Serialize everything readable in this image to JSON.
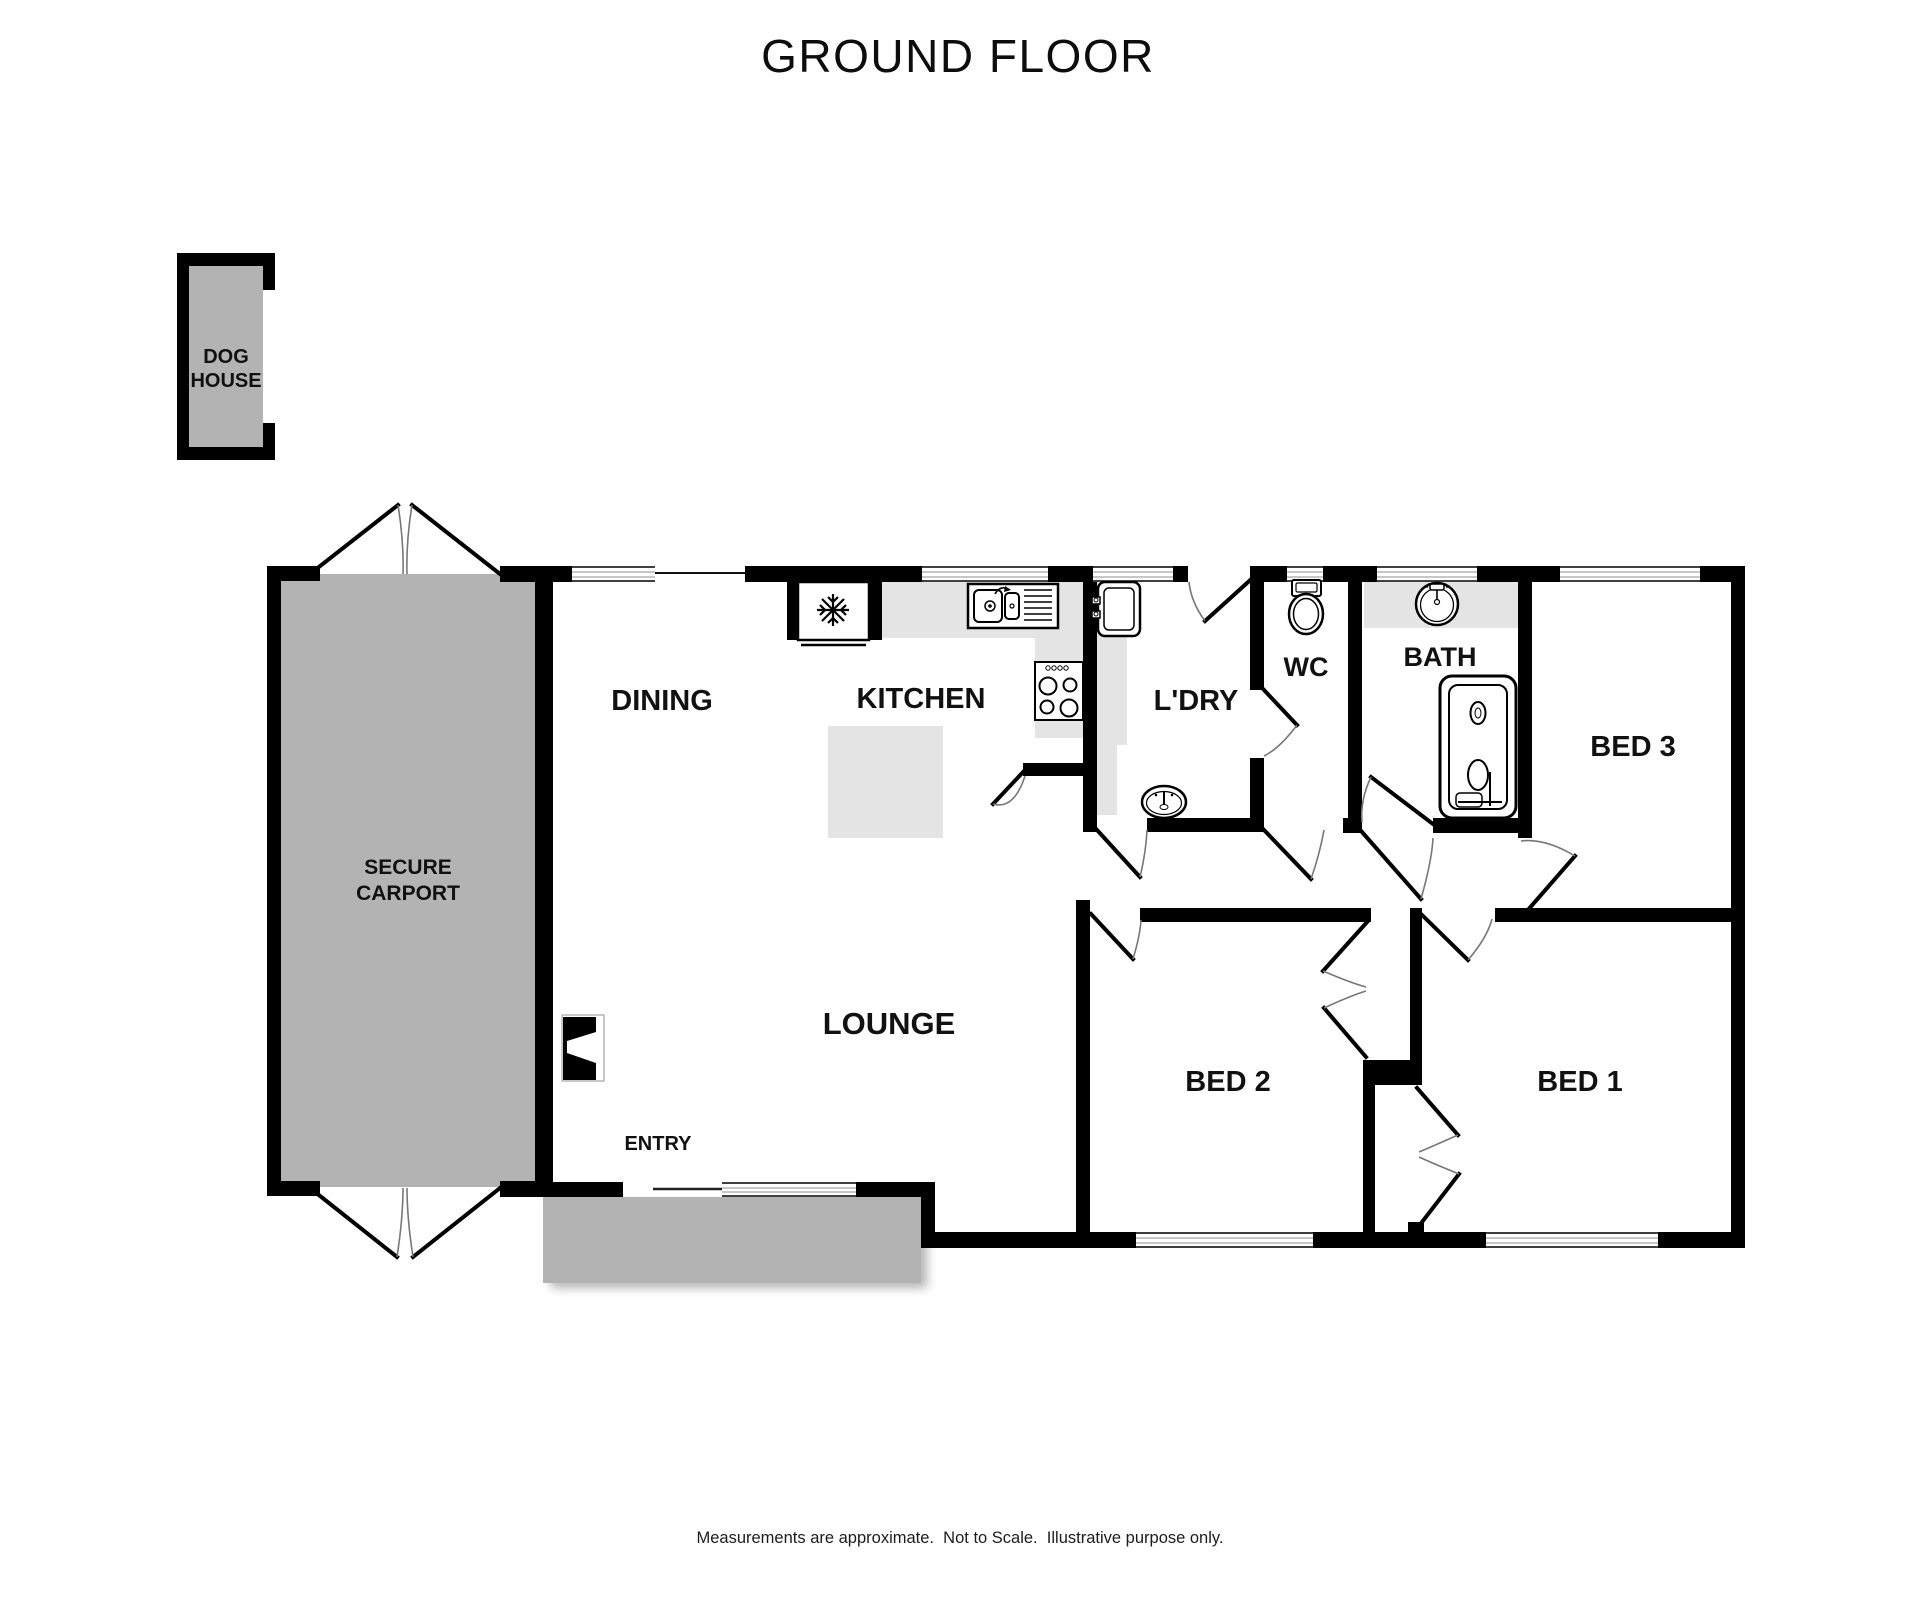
{
  "title": "GROUND FLOOR",
  "disclaimer": "Measurements are approximate.  Not to Scale.  Illustrative purpose only.",
  "rooms": {
    "dog_house": {
      "line1": "DOG",
      "line2": "HOUSE"
    },
    "carport": {
      "line1": "SECURE",
      "line2": "CARPORT"
    },
    "dining": "DINING",
    "kitchen": "KITCHEN",
    "laundry": "L'DRY",
    "wc": "WC",
    "bath": "BATH",
    "bed3": "BED 3",
    "lounge": "LOUNGE",
    "entry": "ENTRY",
    "bed2": "BED 2",
    "bed1": "BED 1"
  },
  "icons": {
    "fridge": "snowflake",
    "kitchen_sink": "double-bowl-sink-with-drainer",
    "stove": "four-burner-cooktop",
    "laundry_tub": "square-tub-with-taps",
    "laundry_basin": "oval-basin",
    "toilet": "toilet-with-cistern",
    "bath_basin": "round-basin-with-tap",
    "bathtub": "bathtub",
    "fireplace": "fireplace-niche",
    "doors": "quarter-swing-arcs",
    "windows": "triple-line-window"
  },
  "colors": {
    "wall": "#000000",
    "outdoor_gray": "#b3b3b3",
    "counter_gray": "#e4e4e4",
    "door_arc_gray": "#777777",
    "background": "#ffffff",
    "text": "#111111"
  }
}
